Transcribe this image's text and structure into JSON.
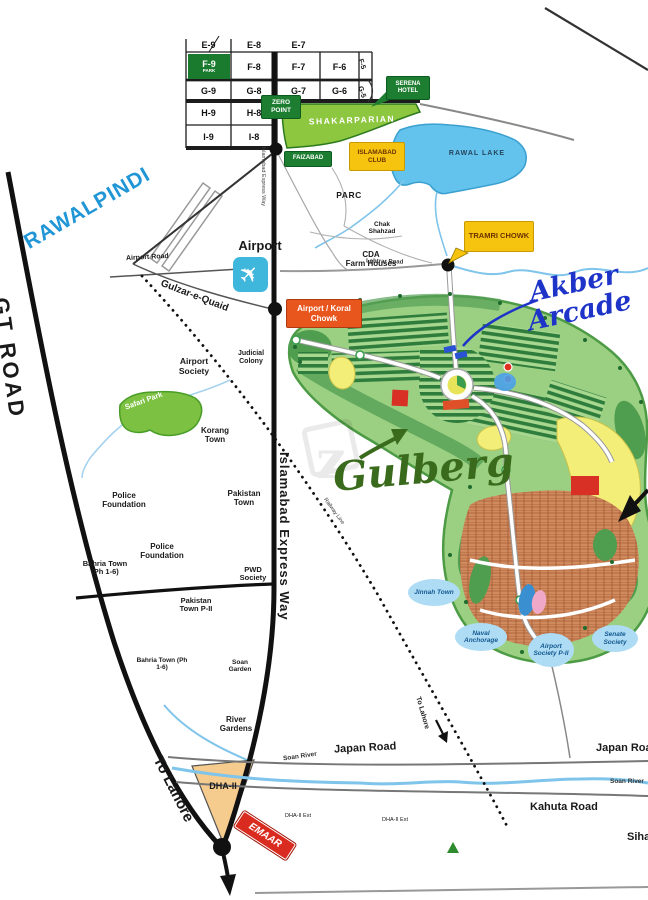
{
  "map": {
    "title": "Gulberg Islamabad location map",
    "colors": {
      "accent_green": "#1d7d31",
      "accent_yellow": "#f6c40e",
      "accent_orange": "#e8561e",
      "accent_red": "#d92b1f",
      "lake_blue": "#63c3ec",
      "society_green": "#9bd083",
      "handwriting_green": "#3a6b1c",
      "handwriting_blue": "#1e34c8",
      "rawalpindi_blue": "#2196d6"
    },
    "sectors": {
      "e9": "E-9",
      "e8": "E-8",
      "e7": "E-7",
      "f9": "F-9",
      "f9_sub": "PARK",
      "f8": "F-8",
      "f7": "F-7",
      "f6": "F-6",
      "f5": "F-5",
      "g9": "G-9",
      "g8": "G-8",
      "g7": "G-7",
      "g6": "G-6",
      "g5": "G-5",
      "h9": "H-9",
      "h8": "H-8",
      "i9": "I-9",
      "i8": "I-8"
    },
    "places": {
      "zero_point": "ZERO POINT",
      "shakarparian": "SHAKARPARIAN",
      "serena_hotel": "SERENA HOTEL",
      "faizabad": "FAIZABAD",
      "islamabad_club": "ISLAMABAD CLUB",
      "rawal_lake": "RAWAL LAKE",
      "parc": "PARC",
      "chak_shahzad": "Chak Shahzad",
      "cda_farm_houses_1": "CDA",
      "cda_farm_houses_2": "Farm Houses",
      "tramri_chowk": "TRAMRI CHOWK",
      "lehtrar_road": "Lehtrar Road",
      "rawalpindi": "RAWALPINDI",
      "airport": "Airport",
      "airport_road": "Airport Road",
      "gulzar_e_quaid": "Gulzar-e-Quaid",
      "airport_koral_chowk": "Airport / Koral Chowk",
      "judicial_colony": "Judicial Colony",
      "airport_society": "Airport Society",
      "safari_park": "Safari Park",
      "korang_town": "Korang Town",
      "police_foundation_1": "Police Foundation",
      "pakistan_town": "Pakistan Town",
      "police_foundation_2": "Police Foundation",
      "bahria_town_1": "Bahria Town (Ph 1-6)",
      "pwd_society": "PWD Society",
      "pakistan_town_p2": "Pakistan Town P-II",
      "bahria_town_2": "Bahria Town (Ph 1-6)",
      "soan_garden": "Soan Garden",
      "river_gardens": "River Gardens",
      "gt_road": "GT ROAD",
      "islamabad_express_way": "Islamabad Express Way",
      "islamabad_express_way_small": "Islamabad Express Way",
      "railway_line": "Railway Line",
      "to_lahore_route": "To Lahore",
      "to_lahore_road": "To Lahore",
      "dha_2": "DHA-II",
      "emaar": "EMAAR",
      "dha_2_ext_1": "DHA-II Ext",
      "dha_2_ext_2": "DHA-II Ext",
      "japan_road_1": "Japan Road",
      "japan_road_2": "Japan Road",
      "soan_river_1": "Soan River",
      "soan_river_2": "Soan River",
      "kahuta_road": "Kahuta Road",
      "sihala": "Sihala",
      "jinnah_town": "Jinnah Town",
      "naval_anchorage": "Naval Anchorage",
      "airport_society_p2": "Airport Society P-II",
      "senate_society": "Senate Society"
    },
    "annotations": {
      "gulberg": "Gulberg",
      "akber_arcade": "Akber Arcade",
      "watermark": "z"
    },
    "icons": {
      "airplane": "✈"
    }
  }
}
